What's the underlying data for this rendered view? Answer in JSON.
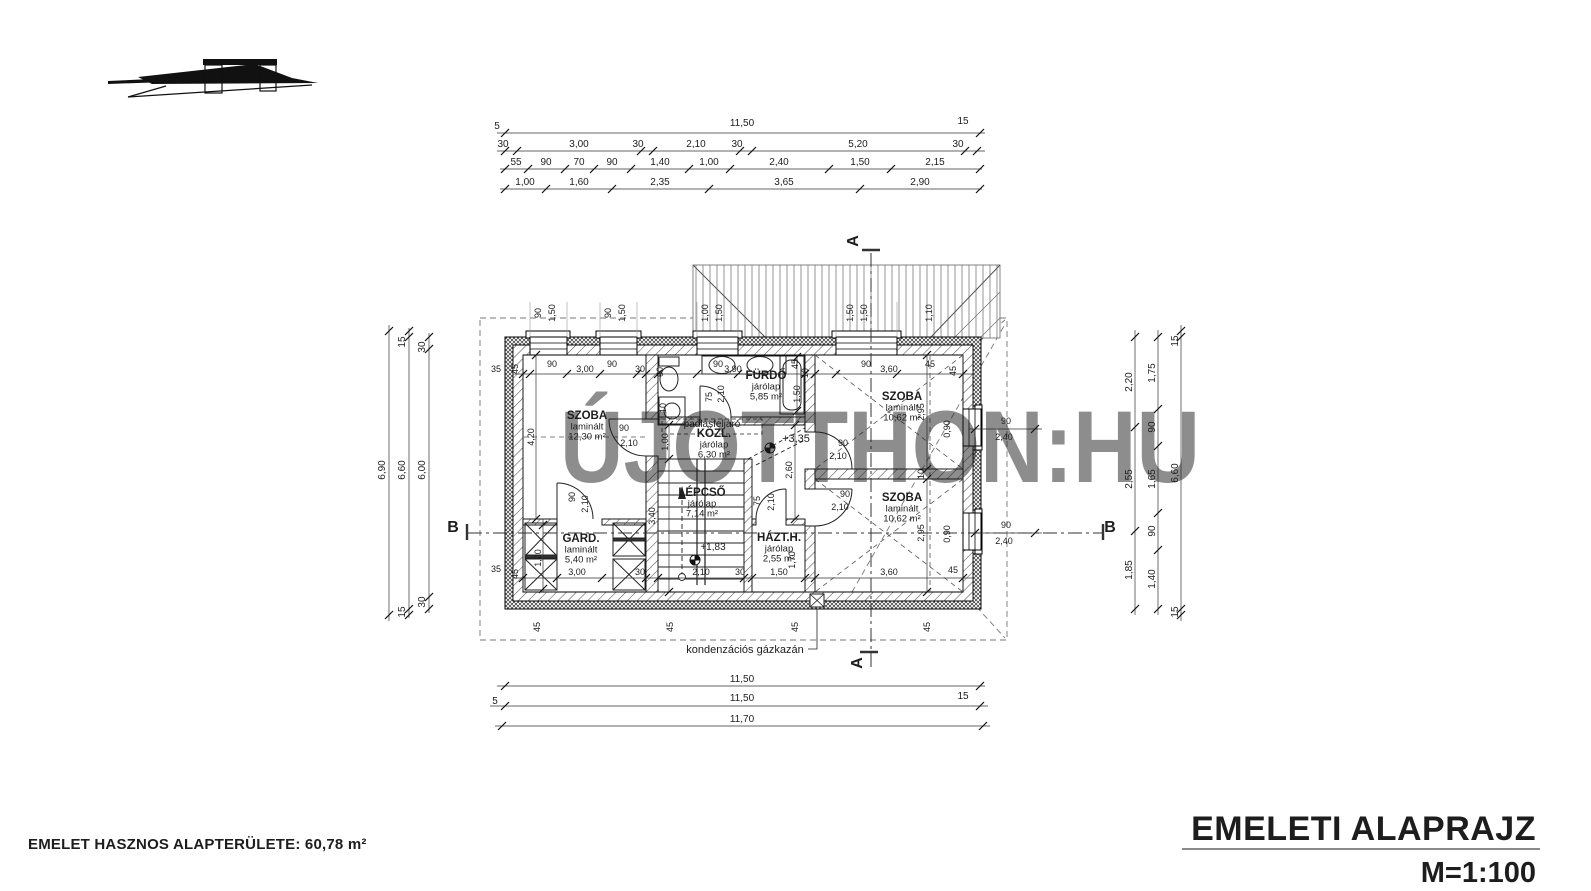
{
  "title_block": {
    "title": "EMELETI ALAPRAJZ",
    "scale": "M=1:100"
  },
  "footer": {
    "area_note": "EMELET HASZNOS ALAPTERÜLETE: 60,78 m²"
  },
  "watermark": "ÚJOTTHON:HU",
  "colors": {
    "line": "#1d1d1d",
    "watermark": "#c9c9c9",
    "rule": "#8a8a8a"
  },
  "rooms": [
    {
      "name": "SZOBA",
      "finish": "laminált",
      "area": "12,30 m²",
      "x": 587,
      "y": 419
    },
    {
      "name": "GARD.",
      "finish": "laminált",
      "area": "5,40 m²",
      "x": 581,
      "y": 542
    },
    {
      "name": "FÜRDŐ",
      "finish": "járólap",
      "area": "5,85 m²",
      "x": 766,
      "y": 379
    },
    {
      "name": "KÖZL.",
      "finish": "járólap",
      "area": "6,30 m²",
      "x": 714,
      "y": 437
    },
    {
      "name": "LÉPCSŐ",
      "finish": "járólap",
      "area": "7,14 m²",
      "x": 702,
      "y": 496
    },
    {
      "name": "HÁZT.H.",
      "finish": "járólap",
      "area": "2,55 m²",
      "x": 779,
      "y": 541
    },
    {
      "name": "SZOBA",
      "finish": "laminált",
      "area": "10,62 m²",
      "x": 902,
      "y": 400
    },
    {
      "name": "SZOBA",
      "finish": "laminált",
      "area": "10,62 m²",
      "x": 902,
      "y": 501
    }
  ],
  "labels": [
    [
      "5",
      497,
      129,
      0
    ],
    [
      "11,50",
      742,
      126,
      0
    ],
    [
      "15",
      963,
      124,
      0
    ],
    [
      "30",
      503,
      147,
      0
    ],
    [
      "3,00",
      579,
      147,
      0
    ],
    [
      "30",
      638,
      147,
      0
    ],
    [
      "2,10",
      696,
      147,
      0
    ],
    [
      "30",
      737,
      147,
      0
    ],
    [
      "5,20",
      858,
      147,
      0
    ],
    [
      "30",
      958,
      147,
      0
    ],
    [
      "55",
      516,
      165,
      0
    ],
    [
      "90",
      546,
      165,
      0
    ],
    [
      "70",
      579,
      165,
      0
    ],
    [
      "90",
      612,
      165,
      0
    ],
    [
      "1,40",
      660,
      165,
      0
    ],
    [
      "1,00",
      709,
      165,
      0
    ],
    [
      "2,40",
      779,
      165,
      0
    ],
    [
      "1,50",
      860,
      165,
      0
    ],
    [
      "2,15",
      935,
      165,
      0
    ],
    [
      "1,00",
      525,
      185,
      0
    ],
    [
      "1,60",
      579,
      185,
      0
    ],
    [
      "2,35",
      660,
      185,
      0
    ],
    [
      "3,65",
      784,
      185,
      0
    ],
    [
      "2,90",
      920,
      185,
      0
    ],
    [
      "11,50",
      742,
      682,
      0
    ],
    [
      "5",
      495,
      704,
      0
    ],
    [
      "11,50",
      742,
      701,
      0
    ],
    [
      "15",
      963,
      699,
      0
    ],
    [
      "11,70",
      742,
      722,
      0
    ],
    [
      "6,90",
      385,
      470,
      1
    ],
    [
      "15",
      405,
      342,
      1
    ],
    [
      "6,60",
      405,
      470,
      1
    ],
    [
      "15",
      405,
      612,
      1
    ],
    [
      "30",
      425,
      347,
      1
    ],
    [
      "6,00",
      425,
      470,
      1
    ],
    [
      "30",
      425,
      602,
      1
    ],
    [
      "2,20",
      1132,
      382,
      1
    ],
    [
      "2,55",
      1132,
      479,
      1
    ],
    [
      "1,85",
      1132,
      570,
      1
    ],
    [
      "1,75",
      1155,
      373,
      1
    ],
    [
      "90",
      1155,
      427,
      1
    ],
    [
      "1,65",
      1155,
      479,
      1
    ],
    [
      "90",
      1155,
      531,
      1
    ],
    [
      "1,40",
      1155,
      579,
      1
    ],
    [
      "15",
      1178,
      341,
      1
    ],
    [
      "6,60",
      1178,
      473,
      1
    ],
    [
      "15",
      1178,
      612,
      1
    ],
    [
      "90",
      541,
      313,
      1,
      9
    ],
    [
      "1,50",
      555,
      313,
      1,
      9
    ],
    [
      "90",
      611,
      313,
      1,
      9
    ],
    [
      "1,50",
      625,
      313,
      1,
      9
    ],
    [
      "1,00",
      708,
      313,
      1,
      9
    ],
    [
      "1,50",
      722,
      313,
      1,
      9
    ],
    [
      "1,50",
      853,
      313,
      1,
      9
    ],
    [
      "1,50",
      867,
      313,
      1,
      9
    ],
    [
      "1,10",
      932,
      313,
      1,
      9
    ],
    [
      "35",
      496,
      372,
      0,
      9
    ],
    [
      "45",
      518,
      369,
      1,
      9
    ],
    [
      "90",
      552,
      367,
      0,
      9
    ],
    [
      "3,00",
      585,
      372,
      0,
      9
    ],
    [
      "30",
      640,
      372,
      0,
      9
    ],
    [
      "90",
      612,
      367,
      0,
      9
    ],
    [
      "60",
      663,
      372,
      1,
      9
    ],
    [
      "90",
      718,
      367,
      0,
      9
    ],
    [
      "3,90",
      733,
      372,
      0,
      9
    ],
    [
      "45",
      798,
      364,
      1,
      9
    ],
    [
      "10",
      808,
      373,
      1,
      9
    ],
    [
      "90",
      866,
      367,
      0,
      9
    ],
    [
      "3,60",
      889,
      372,
      0,
      9
    ],
    [
      "45",
      930,
      367,
      0,
      9
    ],
    [
      "45",
      956,
      371,
      1,
      9
    ],
    [
      "1,50",
      800,
      394,
      1,
      9
    ],
    [
      "10",
      666,
      408,
      1,
      9
    ],
    [
      "35",
      496,
      572,
      0,
      9
    ],
    [
      "45",
      518,
      574,
      1,
      9
    ],
    [
      "3,00",
      577,
      575,
      0,
      9
    ],
    [
      "30",
      640,
      575,
      0,
      9
    ],
    [
      "2,10",
      701,
      575,
      0,
      9
    ],
    [
      "30",
      740,
      575,
      0,
      9
    ],
    [
      "1,50",
      779,
      575,
      0,
      9
    ],
    [
      "3,60",
      889,
      575,
      0,
      9
    ],
    [
      "45",
      953,
      573,
      0,
      9
    ],
    [
      "4,20",
      534,
      437,
      1,
      9
    ],
    [
      "1,00",
      668,
      442,
      1,
      9
    ],
    [
      "3,40",
      655,
      516,
      1,
      9
    ],
    [
      "2,60",
      792,
      470,
      1,
      9
    ],
    [
      "2,95",
      924,
      412,
      1,
      9
    ],
    [
      "0,90",
      950,
      429,
      1,
      9
    ],
    [
      "2,95",
      924,
      533,
      1,
      9
    ],
    [
      "0,90",
      950,
      534,
      1,
      9
    ],
    [
      "10",
      924,
      474,
      1,
      9
    ],
    [
      "1,70",
      795,
      560,
      1,
      9
    ],
    [
      "1,20",
      541,
      558,
      1,
      9
    ],
    [
      "90",
      624,
      431,
      0,
      9
    ],
    [
      "2,10",
      629,
      446,
      0,
      9
    ],
    [
      "90",
      575,
      497,
      1,
      9
    ],
    [
      "2,10",
      588,
      504,
      1,
      9
    ],
    [
      "75",
      712,
      397,
      1,
      9
    ],
    [
      "2,10",
      724,
      394,
      1,
      9
    ],
    [
      "90",
      843,
      446,
      0,
      9
    ],
    [
      "2,10",
      838,
      459,
      0,
      9
    ],
    [
      "90",
      845,
      497,
      0,
      9
    ],
    [
      "2,10",
      840,
      510,
      0,
      9
    ],
    [
      "75",
      760,
      501,
      1,
      9
    ],
    [
      "2,10",
      774,
      502,
      1,
      9
    ],
    [
      "90",
      1006,
      424,
      0,
      9
    ],
    [
      "2,40",
      1004,
      440,
      0,
      9
    ],
    [
      "90",
      1006,
      528,
      0,
      9
    ],
    [
      "2,40",
      1004,
      544,
      0,
      9
    ],
    [
      "A",
      858,
      241,
      1,
      16
    ],
    [
      "A",
      862,
      663,
      1,
      16
    ],
    [
      "B",
      453,
      532,
      0,
      16
    ],
    [
      "B",
      1110,
      532,
      0,
      16
    ],
    [
      "+3,35",
      796,
      442,
      0,
      11
    ],
    [
      "+1,83",
      713,
      550,
      0,
      10
    ],
    [
      "padlásfeljáró",
      712,
      427,
      0,
      10
    ],
    [
      "kondenzációs gázkazán",
      745,
      653,
      0,
      11
    ],
    [
      "45",
      540,
      627,
      1,
      9
    ],
    [
      "45",
      673,
      627,
      1,
      9
    ],
    [
      "45",
      798,
      627,
      1,
      9
    ],
    [
      "45",
      930,
      627,
      1,
      9
    ]
  ]
}
